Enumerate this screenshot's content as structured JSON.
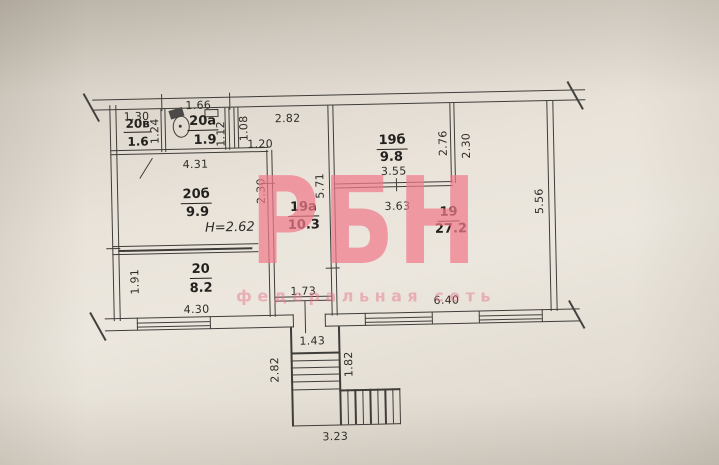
{
  "watermark": {
    "logo": "РБН",
    "tagline": "федеральная сеть",
    "color": "#f07a8b"
  },
  "rooms": {
    "r20v": {
      "name": "20в",
      "area": "1.6"
    },
    "r20a": {
      "name": "20а",
      "area": "1.9"
    },
    "r20b": {
      "name": "20б",
      "area": "9.9"
    },
    "r20": {
      "name": "20",
      "area": "8.2"
    },
    "r19a": {
      "name": "19а",
      "area": "10.3"
    },
    "r19b": {
      "name": "19б",
      "area": "9.8"
    },
    "r19": {
      "name": "19",
      "area": "27.2"
    }
  },
  "height_note": "H=2.62",
  "dims": {
    "d130": "1.30",
    "d124": "1.24",
    "d166": "1.66",
    "d112": "1.12",
    "d108": "1.08",
    "d120": "1.20",
    "d282_top": "2.82",
    "d431": "4.31",
    "d230_20b": "2.30",
    "d571": "5.71",
    "d355": "3.55",
    "d276": "2.76",
    "d230_19": "2.30",
    "d363": "3.63",
    "d556": "5.56",
    "d191": "1.91",
    "d430": "4.30",
    "d173": "1.73",
    "d640": "6.40",
    "d143": "1.43",
    "d282_stair": "2.82",
    "d182": "1.82",
    "d323": "3.23"
  }
}
